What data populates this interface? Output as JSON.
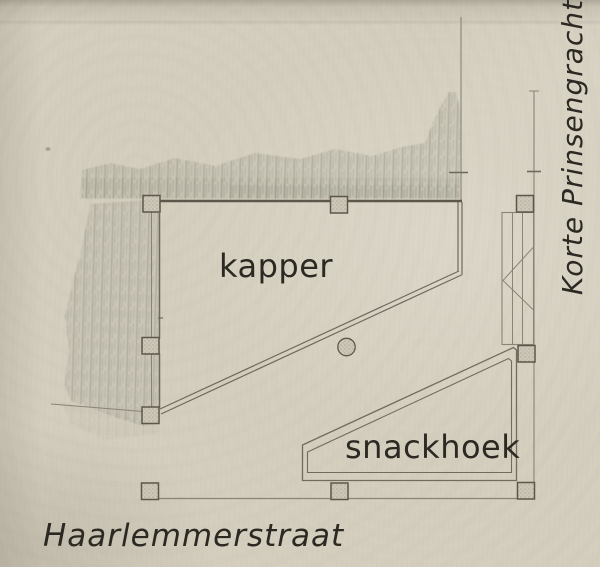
{
  "document": {
    "kind": "scanned architectural floor plan sketch",
    "orientation_note": "street names mark the two facades"
  },
  "labels": {
    "room_kapper": "kapper",
    "room_snackhoek": "snackhoek",
    "street_bottom": "Haarlemmerstraat",
    "street_right": "Korte Prinsengracht"
  },
  "plan": {
    "rooms": [
      {
        "name": "kapper",
        "shape": "irregular polygon with diagonal south wall"
      },
      {
        "name": "snackhoek",
        "shape": "right triangle-like wedge with diagonal north wall"
      }
    ],
    "column_count": 9,
    "round_column_count": 1,
    "stair_run": "right side between kapper and snackhoek",
    "hatched_areas": [
      "adjacent building mass along top",
      "adjacent building mass along left"
    ]
  },
  "colors": {
    "paper": "#d4cebe",
    "wall_dark": "#5c574a",
    "wall_medium": "#6e695c",
    "line_light": "#8a8477",
    "pencil_hatch": "#73756a",
    "text": "#2b2922"
  }
}
